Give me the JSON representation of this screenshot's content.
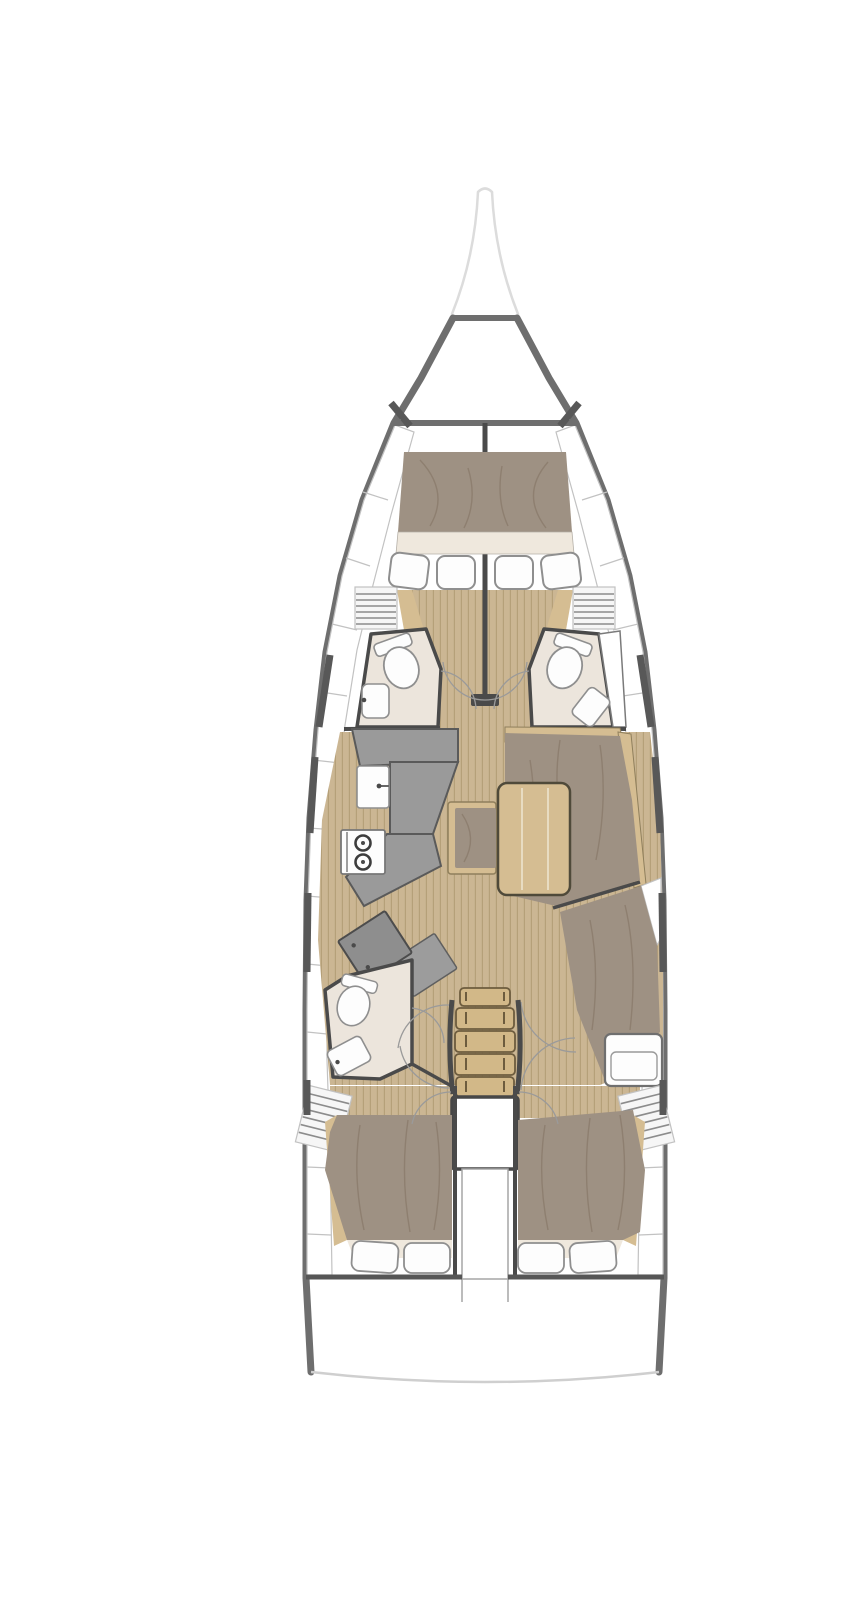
{
  "figure": {
    "type": "yacht-interior-floorplan",
    "description": "Top-down floor plan of a sailing yacht interior, bow up: bowsprit and anchor locker forward, V-berth master cabin with twin en-suite heads, saloon with port galley and nav station, starboard settee with dining table, central companionway stairs over the engine compartment, twin aft double cabins and transom",
    "orientation": "bow-up"
  },
  "areas": {
    "bowsprit": "bowsprit",
    "anchor_locker": "anchor-locker",
    "forward_cabin": "forward-cabin-v-berth",
    "forward_head_port": "forward-head-port",
    "forward_head_starboard": "forward-head-starboard",
    "galley": "galley-port",
    "saloon": "saloon",
    "dining_table": "dining-table",
    "settee": "settee-starboard",
    "nav_station": "nav-station-port",
    "aft_head_port": "aft-head-port",
    "companionway": "companionway-stairs",
    "engine": "engine-compartment",
    "aft_cabin_port": "aft-cabin-port",
    "aft_cabin_starboard": "aft-cabin-starboard",
    "transom": "transom"
  },
  "colors": {
    "bg": "#ffffff",
    "hull": "#6e6e6e",
    "wall": "#4a4a4a",
    "bowsprit": "#dcdcdc",
    "shelf_line": "#c2c2c2",
    "window": "#585858",
    "floor_wood": "#cbb693",
    "floor_stripe": "#b5a079",
    "wood": "#d5bd92",
    "wood_edge": "#8f7f5c",
    "mattress": "#9e9183",
    "mattress_fold": "#857766",
    "cream": "#efe8dd",
    "fixture": "#fdfdfd",
    "fixture_edge": "#8f8f8f",
    "counter": "#9a9a9a",
    "counter_edge": "#5a5a5a",
    "head_floor": "#ece5dc",
    "louver_bg": "#f6f6f6",
    "louver_line": "#8c8c8c",
    "stair_wood": "#d2b888",
    "stair_edge": "#6d5c3e",
    "door_arc": "#9a9a9a",
    "transom_line": "#cfcfcf",
    "table_seam": "#e8dcc2"
  }
}
